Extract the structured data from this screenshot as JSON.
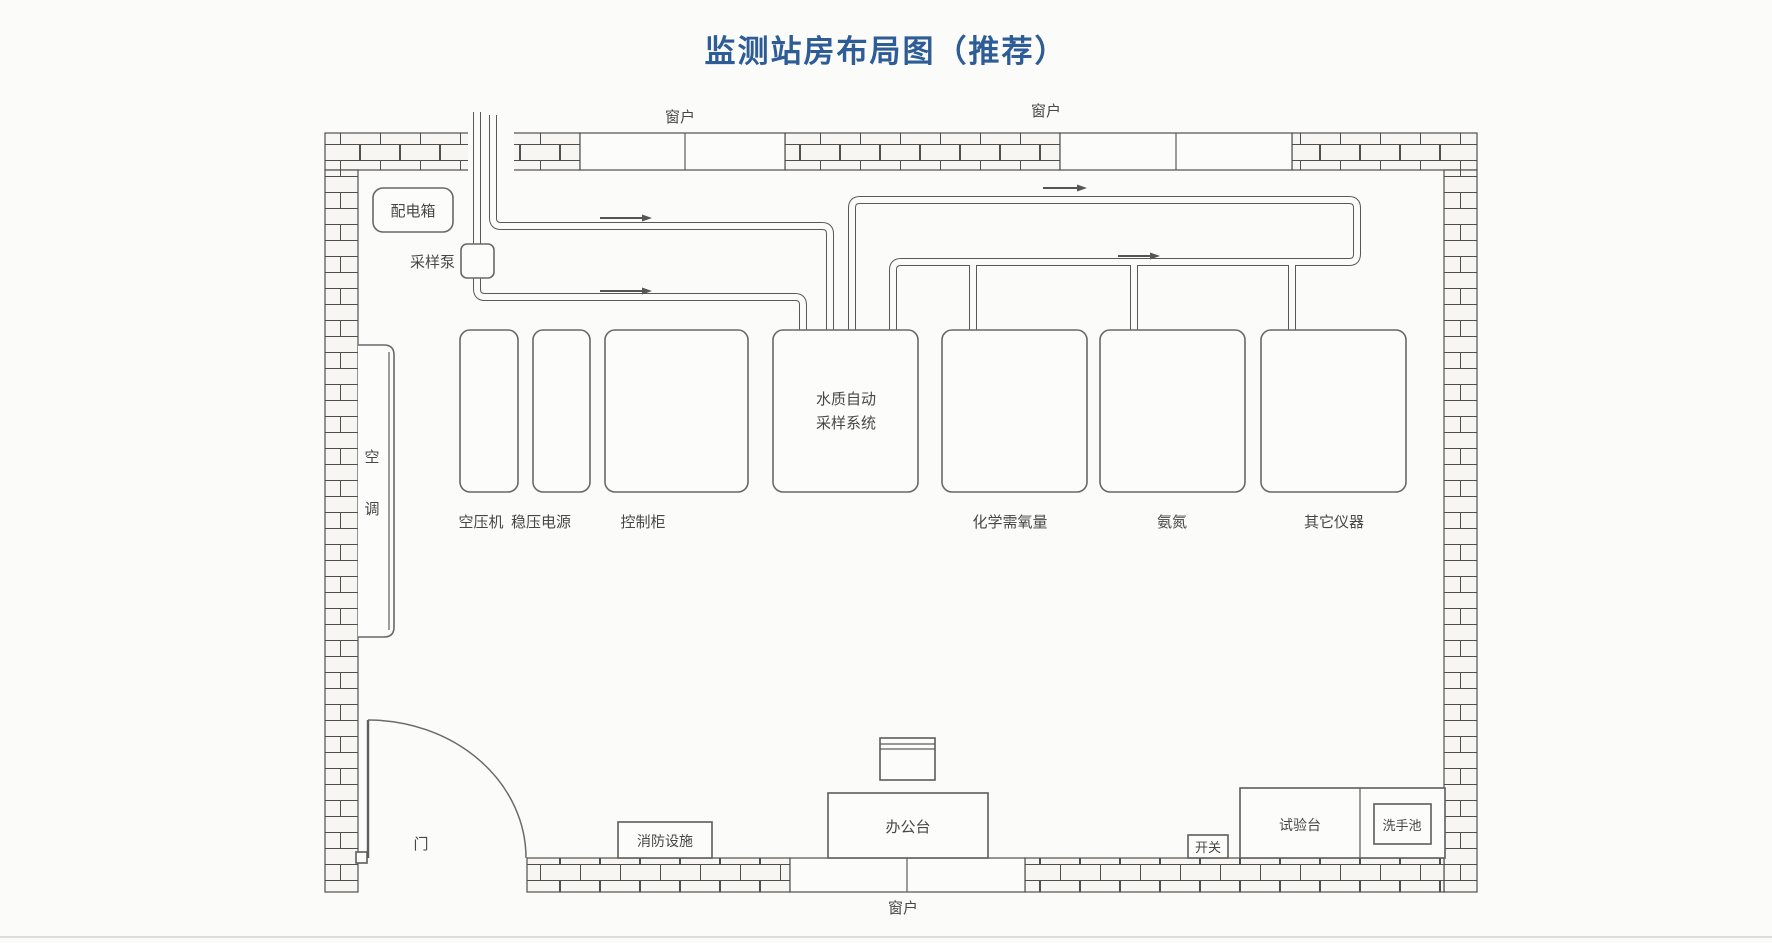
{
  "title": "监测站房布局图（推荐）",
  "colors": {
    "title_blue": "#2d5c97",
    "line_gray": "#555555",
    "background": "#fbfbf9"
  },
  "walls": {
    "window_label": "窗户"
  },
  "door": {
    "label": "门"
  },
  "left_side": {
    "power_distribution_box": "配电箱",
    "sampling_pump": "采样泵",
    "air_conditioner": {
      "char1": "空",
      "char2": "调"
    }
  },
  "equipment_row": {
    "air_compressor": "空压机",
    "voltage_stabilizer": "稳压电源",
    "control_cabinet": "控制柜",
    "water_sampler": {
      "line1": "水质自动",
      "line2": "采样系统"
    },
    "cod_analyzer": "化学需氧量",
    "ammonia_nitrogen": "氨氮",
    "other_instruments": "其它仪器"
  },
  "bottom_area": {
    "fire_equipment": "消防设施",
    "office_desk": "办公台",
    "switch": "开关",
    "test_bench": "试验台",
    "sink": "洗手池"
  }
}
